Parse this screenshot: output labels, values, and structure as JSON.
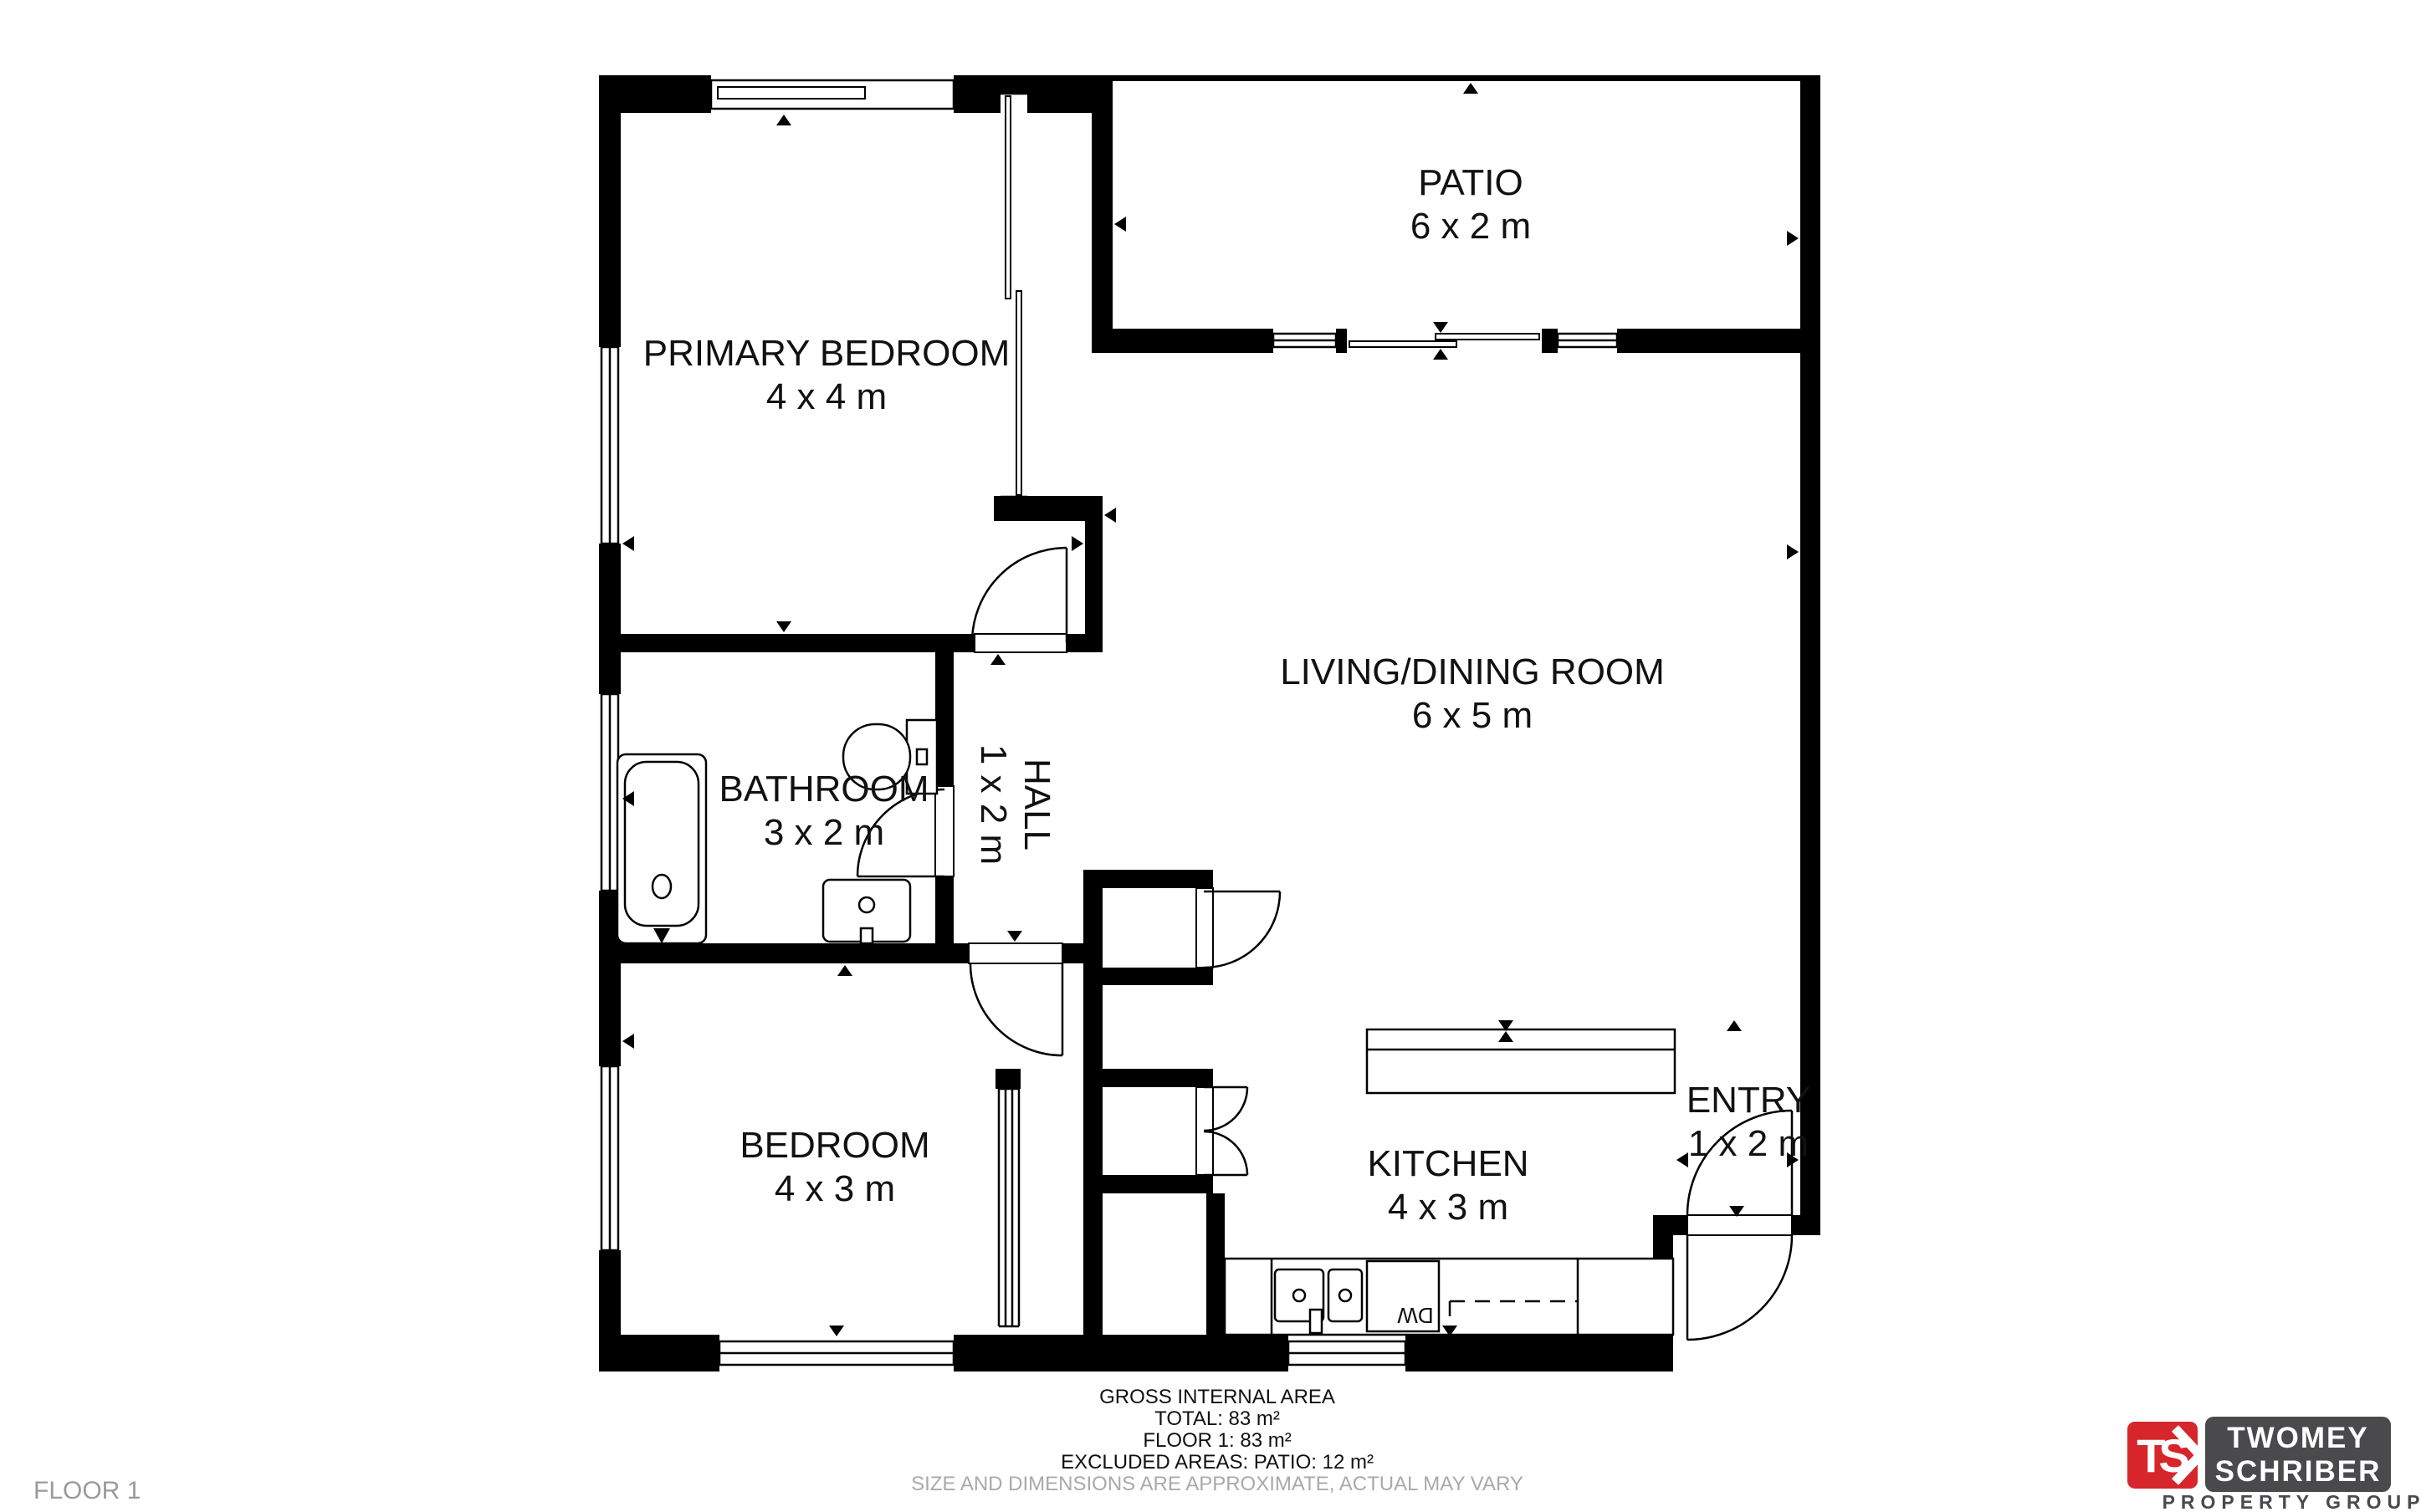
{
  "floor_plan": {
    "rooms": [
      {
        "name": "PRIMARY BEDROOM",
        "dims": "4 x 4 m"
      },
      {
        "name": "PATIO",
        "dims": "6 x 2 m"
      },
      {
        "name": "LIVING/DINING ROOM",
        "dims": "6 x 5 m"
      },
      {
        "name": "BATHROOM",
        "dims": "3 x 2 m"
      },
      {
        "name": "HALL",
        "dims": "1 x 2 m"
      },
      {
        "name": "BEDROOM",
        "dims": "4 x 3 m"
      },
      {
        "name": "KITCHEN",
        "dims": "4 x 3 m"
      },
      {
        "name": "ENTRY",
        "dims": "1 x 2 m"
      }
    ],
    "appliance_labels": {
      "dishwasher": "DW"
    }
  },
  "footer": {
    "area_summary": {
      "title": "GROSS INTERNAL AREA",
      "total": "TOTAL: 83 m²",
      "floor1": "FLOOR 1: 83 m²",
      "excluded": "EXCLUDED AREAS: PATIO: 12 m²",
      "disclaimer": "SIZE AND DIMENSIONS ARE APPROXIMATE, ACTUAL MAY VARY"
    },
    "floor_label": "FLOOR 1"
  },
  "branding": {
    "monogram": "TS",
    "line1": "TWOMEY",
    "line2": "SCHRIBER",
    "tagline": "PROPERTY GROUP",
    "red": "#d6262c",
    "dark": "#4a4a4c"
  }
}
